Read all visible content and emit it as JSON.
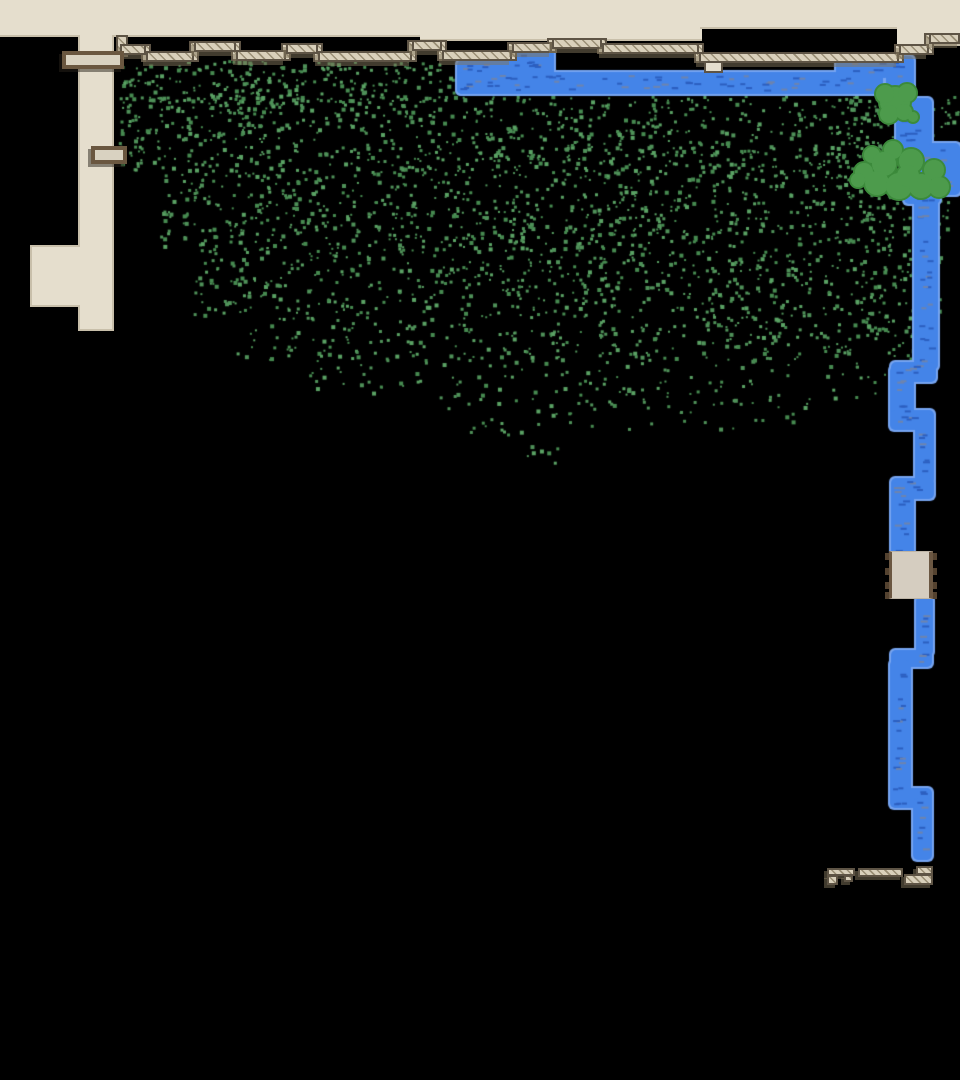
{
  "scene": {
    "width": 960,
    "height": 1080,
    "background": "#000000",
    "palette": {
      "floor": "#e5decd",
      "floor_edge": "#c8bfaa",
      "hatch_fill": "#d9d0bb",
      "hatch_line": "#9a8f76",
      "hatch_border": "#5e5445",
      "shadow": "rgba(130,117,92,0.5)",
      "bridge_frame": "#6a5740",
      "bridge_fill": "#d9d2c1",
      "bridge_shadow": "rgba(40,34,26,0.5)",
      "river_fill": "#4484e8",
      "river_edge": "#76a4f0",
      "river_dash_dark": "#2c5fc0",
      "river_dash_gray": "#6e84ae",
      "tree_fill": "#4d9b4c",
      "tree_edge": "#3c8a3b",
      "grass_colors": [
        "#4f9159",
        "#468a50",
        "#5aa264"
      ],
      "gear_fill": "#d5cdc0",
      "gear_teeth": "#54422f",
      "gear_strip": "#6b5742"
    },
    "floors": {
      "top_band": [
        [
          0,
          0,
          420,
          37
        ],
        [
          420,
          0,
          282,
          41
        ],
        [
          700,
          0,
          197,
          29
        ],
        [
          897,
          0,
          63,
          46
        ]
      ],
      "column": [
        78,
        35,
        36,
        296
      ],
      "arm": [
        30,
        245,
        50,
        62
      ],
      "ledge_tab": [
        704,
        61,
        19,
        12
      ]
    },
    "hatch_segments": [
      [
        120,
        44,
        26
      ],
      [
        146,
        51,
        48
      ],
      [
        194,
        41,
        42
      ],
      [
        236,
        50,
        50
      ],
      [
        286,
        43,
        32
      ],
      [
        318,
        51,
        94
      ],
      [
        412,
        40,
        30
      ],
      [
        442,
        50,
        70
      ],
      [
        512,
        42,
        40
      ],
      [
        552,
        38,
        50
      ],
      [
        602,
        43,
        97
      ],
      [
        699,
        52,
        200
      ],
      [
        899,
        44,
        30
      ],
      [
        929,
        33,
        31
      ]
    ],
    "hatch_height": 11,
    "extra_connectors": [
      [
        116,
        35,
        12,
        22
      ]
    ],
    "bridges": [
      [
        62,
        51,
        62,
        18
      ],
      [
        91,
        146,
        36,
        18
      ]
    ],
    "river_segments": [
      [
        457,
        60,
        68,
        34
      ],
      [
        516,
        49,
        38,
        30
      ],
      [
        457,
        72,
        426,
        22
      ],
      [
        836,
        56,
        54,
        22
      ],
      [
        886,
        56,
        28,
        52
      ],
      [
        896,
        98,
        36,
        58
      ],
      [
        904,
        146,
        36,
        58
      ],
      [
        928,
        143,
        32,
        52
      ],
      [
        914,
        190,
        24,
        180
      ],
      [
        891,
        362,
        45,
        20
      ],
      [
        890,
        366,
        24,
        52
      ],
      [
        890,
        410,
        44,
        20
      ],
      [
        915,
        414,
        19,
        70
      ],
      [
        891,
        478,
        43,
        21
      ],
      [
        891,
        482,
        23,
        74
      ],
      [
        916,
        596,
        17,
        60
      ],
      [
        891,
        650,
        41,
        17
      ],
      [
        890,
        660,
        21,
        136
      ],
      [
        890,
        788,
        42,
        20
      ],
      [
        913,
        798,
        19,
        62
      ]
    ],
    "river_dash_seed": 77,
    "trees": [
      [
        895,
        102,
        16
      ],
      [
        885,
        94,
        10
      ],
      [
        907,
        93,
        10
      ],
      [
        889,
        114,
        10
      ],
      [
        904,
        112,
        9
      ],
      [
        913,
        117,
        6
      ],
      [
        893,
        150,
        10
      ],
      [
        872,
        155,
        9
      ],
      [
        884,
        164,
        13
      ],
      [
        911,
        161,
        13
      ],
      [
        934,
        170,
        11
      ],
      [
        864,
        172,
        10
      ],
      [
        877,
        183,
        13
      ],
      [
        899,
        186,
        14
      ],
      [
        921,
        186,
        13
      ],
      [
        939,
        187,
        11
      ],
      [
        858,
        180,
        8
      ],
      [
        908,
        176,
        12
      ]
    ],
    "grass_seed": 1337,
    "grass_patches": [
      [
        118,
        60,
        335,
        42,
        240
      ],
      [
        118,
        95,
        840,
        75,
        880
      ],
      [
        160,
        170,
        790,
        75,
        760
      ],
      [
        190,
        245,
        750,
        70,
        580
      ],
      [
        235,
        315,
        690,
        45,
        280
      ],
      [
        300,
        355,
        600,
        45,
        130
      ],
      [
        440,
        395,
        370,
        40,
        55
      ],
      [
        522,
        438,
        50,
        25,
        7
      ],
      [
        830,
        55,
        55,
        135,
        60
      ],
      [
        858,
        195,
        52,
        145,
        60
      ]
    ],
    "gear_bridge": {
      "rect": [
        889,
        551,
        44,
        48
      ],
      "teeth_y": [
        553,
        568,
        582,
        592
      ],
      "tooth_w": 6,
      "tooth_h": 7
    },
    "ramps_bottom": [
      [
        827,
        868,
        28,
        8
      ],
      [
        827,
        875,
        11,
        10
      ],
      [
        844,
        875,
        9,
        7
      ],
      [
        858,
        868,
        45,
        9
      ],
      [
        916,
        866,
        17,
        9
      ],
      [
        904,
        874,
        29,
        11
      ]
    ]
  }
}
